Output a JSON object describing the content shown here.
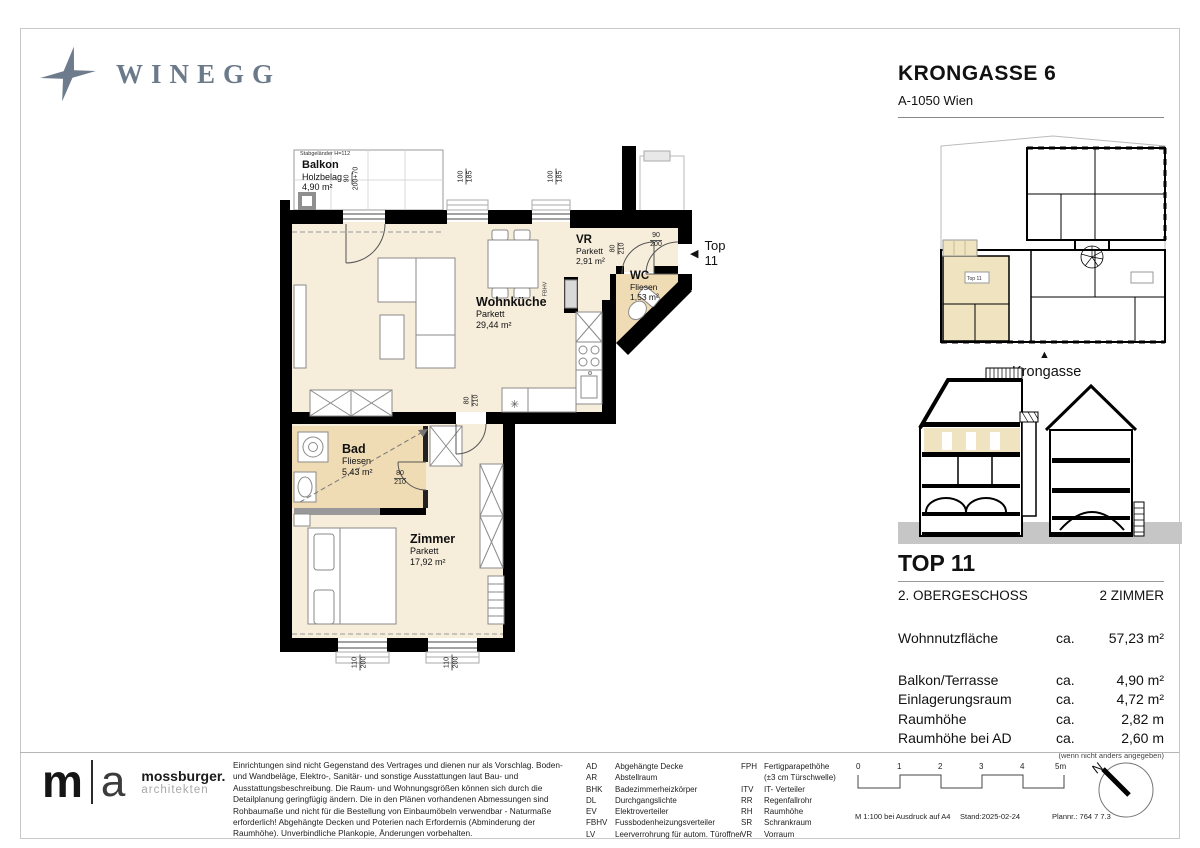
{
  "brand": {
    "logo_text": "WINEGG"
  },
  "project": {
    "title": "KRONGASSE 6",
    "address": "A-1050 Wien"
  },
  "floorplan": {
    "rooms": [
      {
        "name": "Balkon",
        "finish": "Holzbelag",
        "area": "4,90 m²"
      },
      {
        "name": "Wohnküche",
        "finish": "Parkett",
        "area": "29,44 m²"
      },
      {
        "name": "VR",
        "finish": "Parkett",
        "area": "2,91 m²"
      },
      {
        "name": "WC",
        "finish": "Fliesen",
        "area": "1,53 m²"
      },
      {
        "name": "Bad",
        "finish": "Fliesen",
        "area": "5,43 m²"
      },
      {
        "name": "Zimmer",
        "finish": "Parkett",
        "area": "17,92 m²"
      }
    ],
    "railing_note": "Stabgeländer H=112",
    "fbhv_label": "FBHV",
    "entrance": {
      "arrow": "◀",
      "label": "Top 11"
    },
    "appliance_symbol": "✳",
    "dims": {
      "balcony_door": {
        "t": "90",
        "b": "200+70"
      },
      "window_top": {
        "t": "100",
        "b": "185"
      },
      "entrance_door": {
        "t": "90",
        "b": "200"
      },
      "interior_door": {
        "t": "80",
        "b": "210"
      },
      "window_bottom": {
        "t": "110",
        "b": "200"
      }
    }
  },
  "siteplan": {
    "street_label": "Krongasse",
    "marker": "▲",
    "unit_label": "Top 11"
  },
  "unit": {
    "top": "TOP 11",
    "floor": "2. OBERGESCHOSS",
    "rooms": "2 ZIMMER",
    "main_metric": {
      "label": "Wohnnutzfläche",
      "ca": "ca.",
      "value": "57,23 m²"
    },
    "metrics": [
      {
        "label": "Balkon/Terrasse",
        "ca": "ca.",
        "value": "4,90 m²"
      },
      {
        "label": "Einlagerungsraum",
        "ca": "ca.",
        "value": "4,72 m²"
      },
      {
        "label": "Raumhöhe",
        "ca": "ca.",
        "value": "2,82 m"
      },
      {
        "label": "Raumhöhe bei AD",
        "ca": "ca.",
        "value": "2,60 m"
      }
    ],
    "note": "(wenn nicht anders angegeben)"
  },
  "footer": {
    "architect": {
      "initial_left": "m",
      "initial_right": "a",
      "name": "mossburger.",
      "sub": "architekten"
    },
    "disclaimer": "Einrichtungen sind nicht Gegenstand des Vertrages und dienen nur als Vorschlag. Boden- und Wandbeläge, Elektro-, Sanitär- und sonstige Ausstattungen laut Bau- und Ausstattungsbeschreibung. Die Raum- und Wohnungsgrößen können sich durch die Detailplanung geringfügig ändern. Die in den Plänen vorhandenen Abmessungen sind Rohbaumaße und nicht für die Bestellung von Einbaumöbeln verwendbar - Naturmaße erforderlich! Abgehängte Decken und Poterien nach Erfordernis (Abminderung der Raumhöhe). Unverbindliche Plankopie, Änderungen vorbehalten.",
    "legend_left": [
      {
        "abbr": "AD",
        "term": "Abgehängte Decke"
      },
      {
        "abbr": "AR",
        "term": "Abstellraum"
      },
      {
        "abbr": "BHK",
        "term": "Badezimmerheizkörper"
      },
      {
        "abbr": "DL",
        "term": "Durchgangslichte"
      },
      {
        "abbr": "EV",
        "term": "Elektroverteiler"
      },
      {
        "abbr": "FBHV",
        "term": "Fussbodenheizungsverteiler"
      },
      {
        "abbr": "LV",
        "term": "Leerverrohrung für autom. Türoffner"
      }
    ],
    "legend_right": [
      {
        "abbr": "FPH",
        "term": "Fertigparapethöhe"
      },
      {
        "abbr": "",
        "term": "(±3 cm Türschwelle)"
      },
      {
        "abbr": "ITV",
        "term": "IT- Verteiler"
      },
      {
        "abbr": "RR",
        "term": "Regenfallrohr"
      },
      {
        "abbr": "RH",
        "term": "Raumhöhe"
      },
      {
        "abbr": "SR",
        "term": "Schrankraum"
      },
      {
        "abbr": "VR",
        "term": "Vorraum"
      }
    ],
    "scale": {
      "ticks": [
        "0",
        "1",
        "2",
        "3",
        "4",
        "5m"
      ],
      "print_note": "M 1:100 bei Ausdruck auf A4",
      "date": "Stand:2025-02-24",
      "plan_no": "Plannr.: 764 7 7.3"
    },
    "north_label": "N"
  },
  "colors": {
    "floor": "#f6eddb",
    "wet_floor": "#f0dcb4",
    "wall": "#000000",
    "brand": "#6d7b8c",
    "highlight": "#f0e3c0"
  }
}
